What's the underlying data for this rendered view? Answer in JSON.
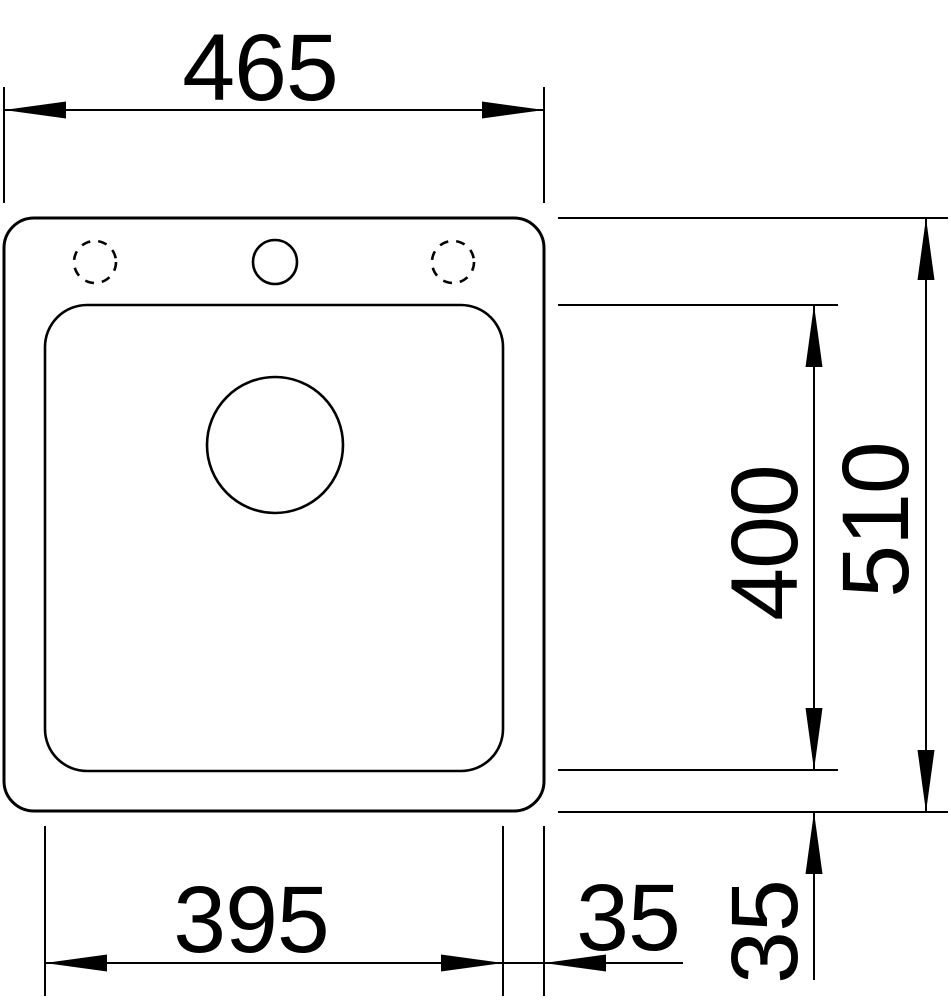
{
  "diagram": {
    "kind": "technical-dimension-drawing",
    "subject": "sink-top-view",
    "colors": {
      "line": "#000000",
      "background": "#ffffff"
    },
    "labels": {
      "overall_width": "465",
      "overall_depth": "510",
      "bowl_width": "395",
      "bowl_depth": "400",
      "bowl_offset_right": "35",
      "bowl_offset_bottom": "35"
    }
  }
}
